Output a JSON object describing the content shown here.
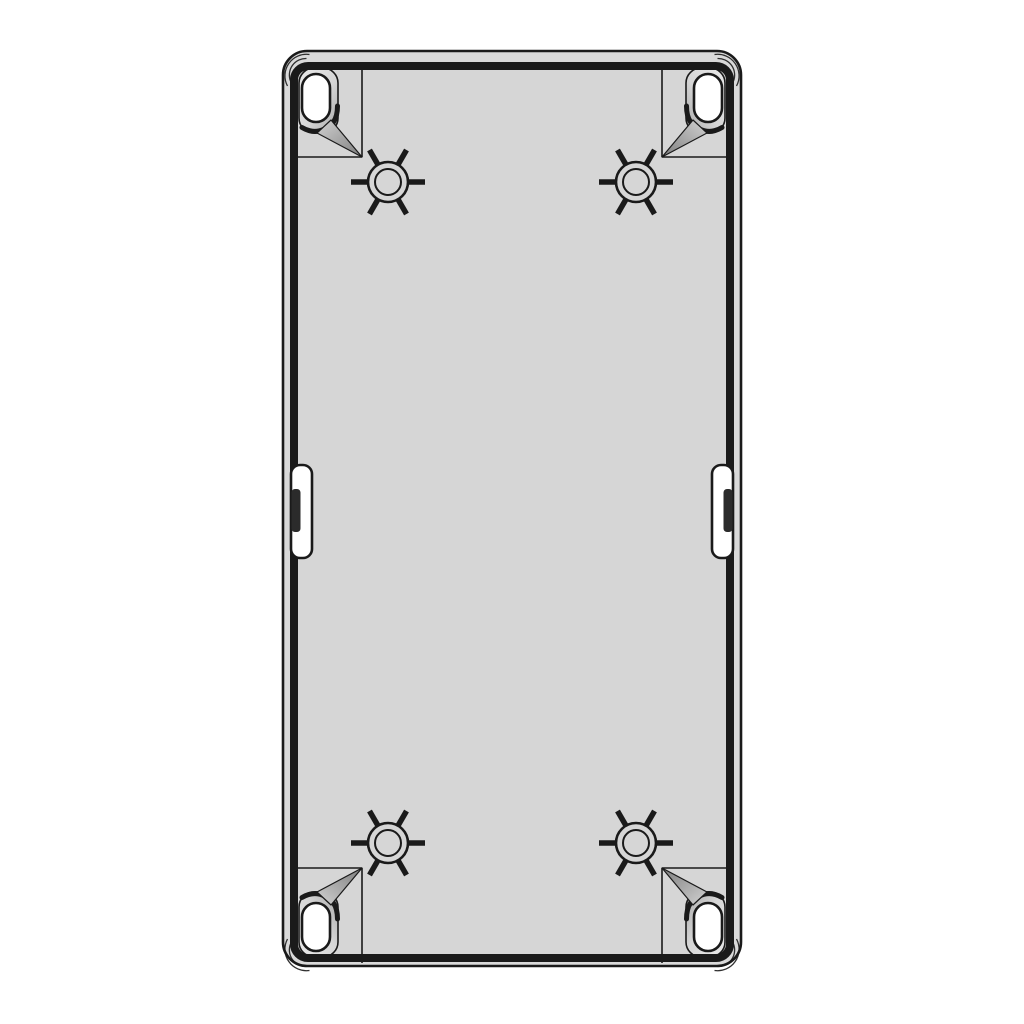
{
  "colors": {
    "background": "#ffffff",
    "line": "#1a1a1a",
    "rim": "#d9d9d9",
    "body": "#d6d6d6",
    "hole": "#ffffff",
    "slot": "#2b2b2b",
    "boss_light": "#e9e9e9",
    "boss_dark": "#a6a6a6",
    "wedge_light": "#d2d2d2",
    "wedge_dark": "#7e7e7e"
  },
  "features": {
    "corner_assemblies": [
      {
        "id": "top-left",
        "transform": "matrix(1,0,0,1,0,0)"
      },
      {
        "id": "top-right",
        "transform": "matrix(-1,0,0,1,1024,0)"
      },
      {
        "id": "bottom-left",
        "transform": "matrix(1,0,0,-1,0,1025)"
      },
      {
        "id": "bottom-right",
        "transform": "matrix(-1,0,0,-1,1024,1025)"
      }
    ],
    "screw_bosses": [
      {
        "id": "top-left",
        "transform": "translate(388,182)"
      },
      {
        "id": "top-right",
        "transform": "translate(636,182)"
      },
      {
        "id": "bottom-left",
        "transform": "translate(388,843)"
      },
      {
        "id": "bottom-right",
        "transform": "translate(636,843)"
      }
    ],
    "side_tabs": [
      {
        "id": "left",
        "transform": "matrix(1,0,0,1,0,0)"
      },
      {
        "id": "right",
        "transform": "matrix(-1,0,0,1,1024,0)"
      }
    ]
  }
}
